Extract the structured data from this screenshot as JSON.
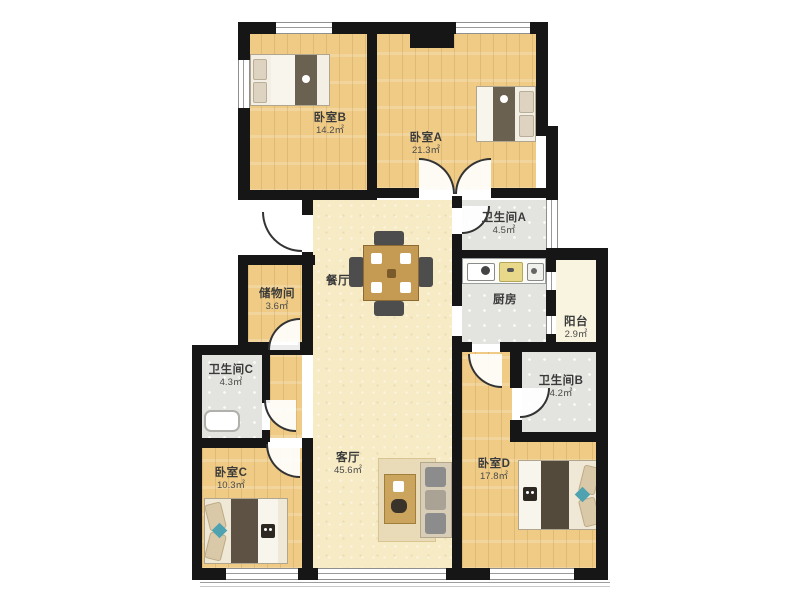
{
  "floorplan": {
    "type": "apartment-floor-plan",
    "rooms": [
      {
        "id": "bedroom-b",
        "label": "卧室B",
        "area": "14.2㎡"
      },
      {
        "id": "bedroom-a",
        "label": "卧室A",
        "area": "21.3㎡"
      },
      {
        "id": "bathroom-a",
        "label": "卫生间A",
        "area": "4.5㎡"
      },
      {
        "id": "dining",
        "label": "餐厅",
        "area": ""
      },
      {
        "id": "storage",
        "label": "储物间",
        "area": "3.6㎡"
      },
      {
        "id": "kitchen",
        "label": "厨房",
        "area": ""
      },
      {
        "id": "balcony",
        "label": "阳台",
        "area": "2.9㎡"
      },
      {
        "id": "bathroom-c",
        "label": "卫生间C",
        "area": "4.3㎡"
      },
      {
        "id": "bedroom-c",
        "label": "卧室C",
        "area": "10.3㎡"
      },
      {
        "id": "living",
        "label": "客厅",
        "area": "45.6㎡"
      },
      {
        "id": "bedroom-d",
        "label": "卧室D",
        "area": "17.8㎡"
      },
      {
        "id": "bathroom-b",
        "label": "卫生间B",
        "area": "4.2㎡"
      }
    ],
    "colors": {
      "wall": "#161616",
      "wood_floor": "#efcb85",
      "living_floor": "#f7ebc6",
      "tile_floor": "#e3e3df",
      "balcony_floor": "#f9f4df",
      "accent_teal": "#4fa3b0"
    }
  }
}
